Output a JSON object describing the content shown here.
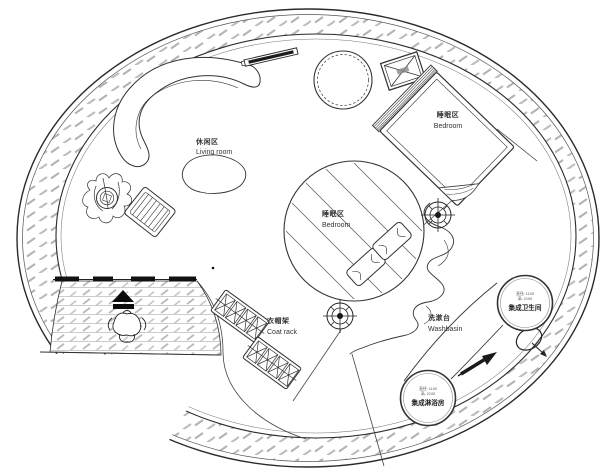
{
  "plan": {
    "areas": {
      "living": {
        "zh": "休闲区",
        "en": "Living room"
      },
      "bedroom_upper": {
        "zh": "睡眠区",
        "en": "Bedroom"
      },
      "bedroom_center": {
        "zh": "睡眠区",
        "en": "Bedroom"
      },
      "coat_rack": {
        "zh": "衣帽架",
        "en": "Coat rack"
      },
      "washbasin": {
        "zh": "洗漱台",
        "en": "Washbasin"
      },
      "toilet_pod": {
        "name": "集成卫生间",
        "spec_line1": "直径: 1100",
        "spec_line2": "高: 2100"
      },
      "shower_pod": {
        "name": "集成淋浴房",
        "spec_line1": "直径: 1100",
        "spec_line2": "高: 2100"
      }
    },
    "colors": {
      "ink": "#2a2a2a",
      "hatch": "#ababab",
      "paper": "#ffffff"
    }
  }
}
